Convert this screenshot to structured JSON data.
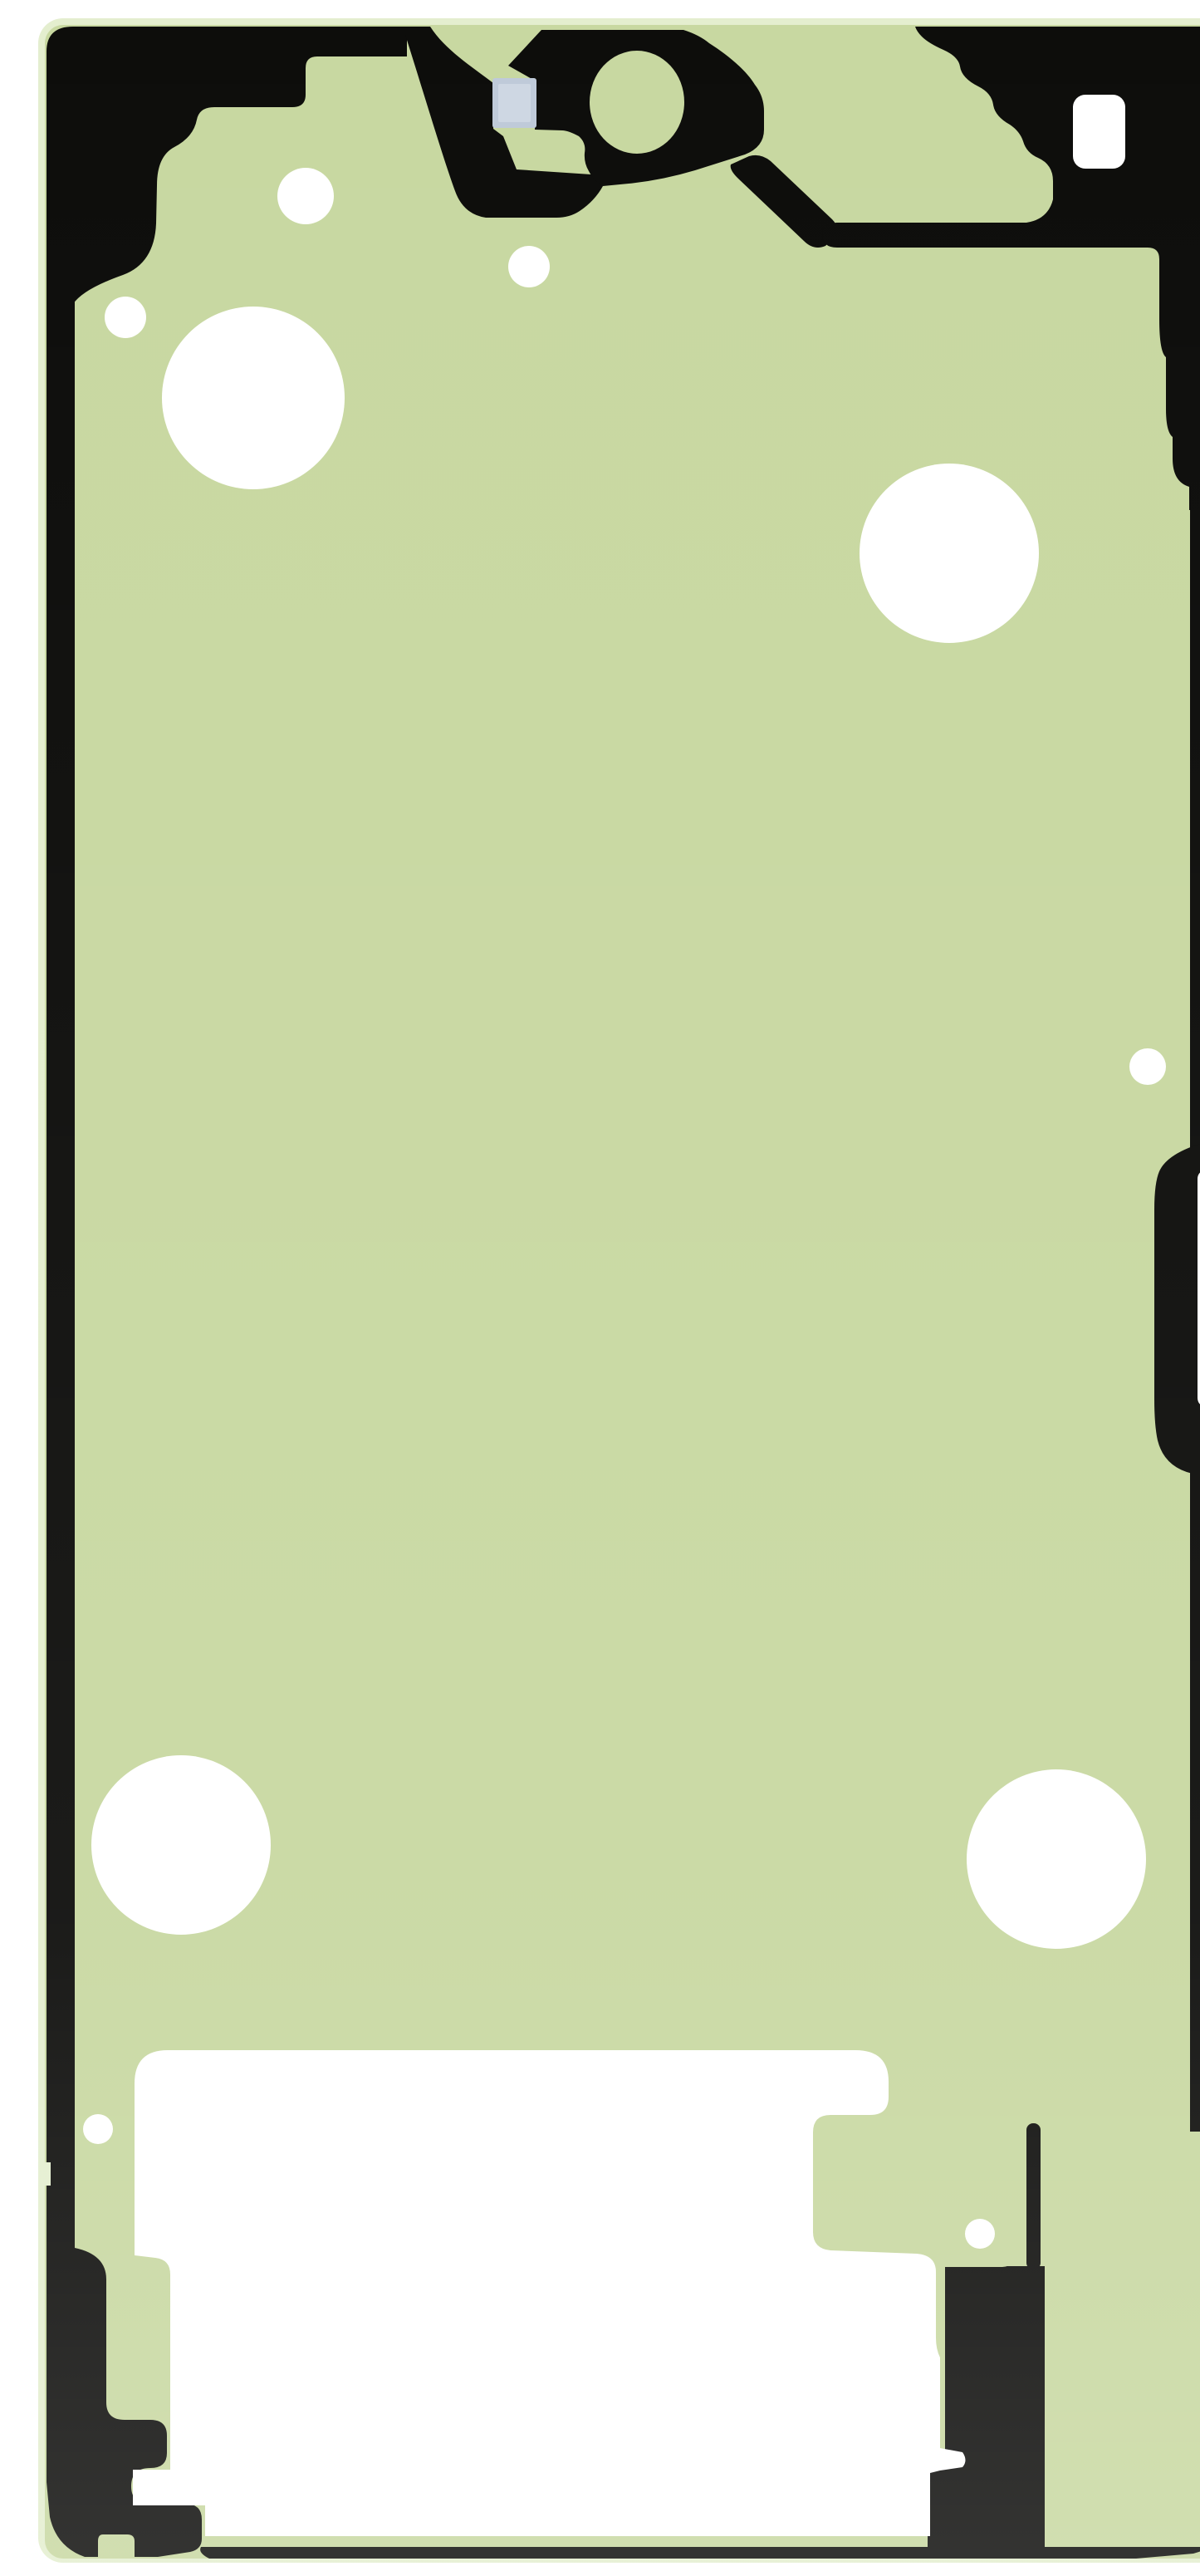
{
  "meta": {
    "description": "Product photograph of a green battery back-cover adhesive gasket sticker for a smartphone, shown flat on a white background. The tall rounded sheet has black printed border and antenna regions, a circular rear-camera cutout at the top center, a small light-blue pull tab, several round die-cut holes, a narrow slot cutout on the right edge, and a large white die-cut window near the bottom.",
    "object": "adhesive-gasket-sticker"
  },
  "colors": {
    "background": "#ffffff",
    "sheet_edge": "#e4eecf",
    "sheet_green": "#c8d8a1",
    "sheet_green_deep": "#c2d399",
    "print_black": "#0d0d0b",
    "blue_tab": "#bfcad9",
    "blue_tab_light": "#d3dbe6",
    "cutout_white": "#ffffff"
  }
}
